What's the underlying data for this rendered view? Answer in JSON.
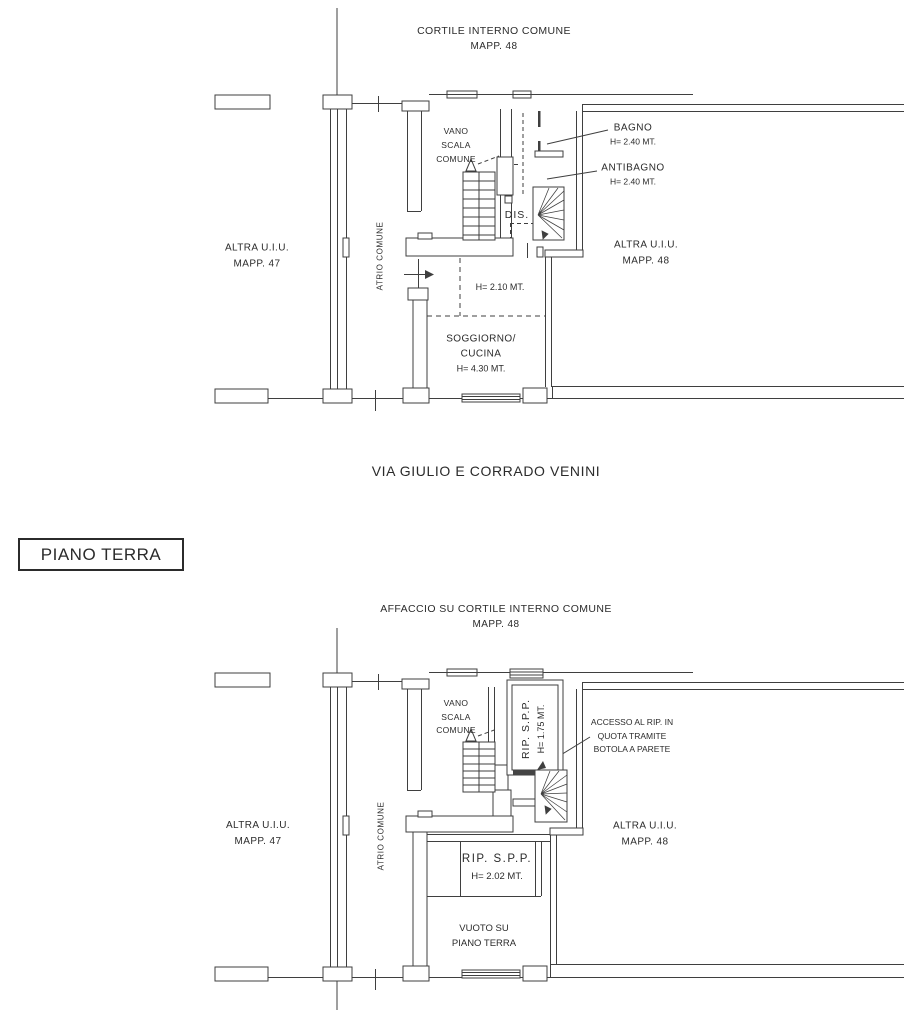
{
  "colors": {
    "ink": "#2b2b2b",
    "line": "#3f3f3f"
  },
  "street_label": "VIA GIULIO E CORRADO VENINI",
  "floor_title": "PIANO TERRA",
  "plan_piano_terra": {
    "courtyard_title": "CORTILE INTERNO COMUNE",
    "courtyard_mapp": "MAPP. 48",
    "vano_scala_l1": "VANO",
    "vano_scala_l2": "SCALA",
    "vano_scala_l3": "COMUNE",
    "bagno_name": "BAGNO",
    "bagno_h": "H= 2.40 MT.",
    "antibagno_name": "ANTIBAGNO",
    "antibagno_h": "H= 2.40 MT.",
    "dis": "DIS.",
    "atrio": "ATRIO COMUNE",
    "altra_left_l1": "ALTRA U.I.U.",
    "altra_left_l2": "MAPP. 47",
    "altra_right_l1": "ALTRA U.I.U.",
    "altra_right_l2": "MAPP. 48",
    "h_mezzanine": "H= 2.10 MT.",
    "soggiorno_l1": "SOGGIORNO/",
    "soggiorno_l2": "CUCINA",
    "soggiorno_h": "H= 4.30 MT."
  },
  "plan_soppalco": {
    "courtyard_title": "AFFACCIO SU CORTILE INTERNO COMUNE",
    "courtyard_mapp": "MAPP. 48",
    "vano_scala_l1": "VANO",
    "vano_scala_l2": "SCALA",
    "vano_scala_l3": "COMUNE",
    "rip_name": "RIP. S.P.P.",
    "rip_h": "H= 1.75 MT.",
    "accesso_l1": "ACCESSO AL RIP. IN",
    "accesso_l2": "QUOTA TRAMITE",
    "accesso_l3": "BOTOLA A PARETE",
    "atrio": "ATRIO COMUNE",
    "altra_left_l1": "ALTRA U.I.U.",
    "altra_left_l2": "MAPP. 47",
    "altra_right_l1": "ALTRA U.I.U.",
    "altra_right_l2": "MAPP. 48",
    "rip2_name": "RIP. S.P.P.",
    "rip2_h": "H= 2.02 MT.",
    "vuoto_l1": "VUOTO SU",
    "vuoto_l2": "PIANO TERRA"
  }
}
